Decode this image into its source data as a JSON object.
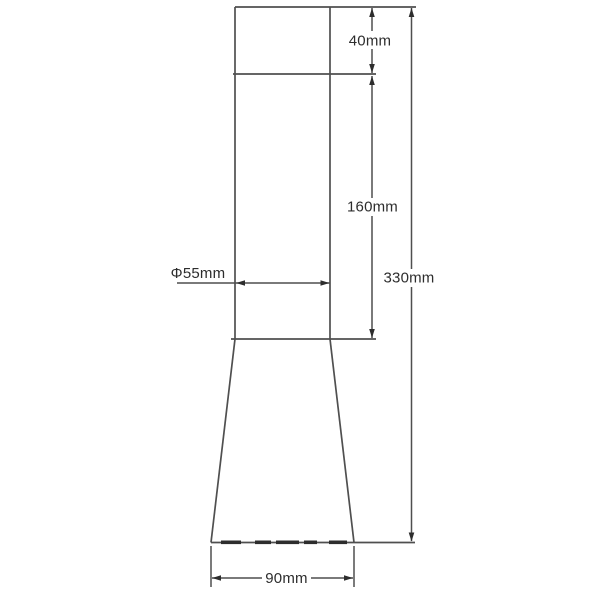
{
  "drawing": {
    "type": "technical-dimension-drawing",
    "labels": {
      "cap_height": "40mm",
      "body_height": "160mm",
      "total_height": "330mm",
      "diameter": "Φ55mm",
      "base_width": "90mm"
    },
    "colors": {
      "line": "#4f4f4f",
      "text": "#2d2d2d",
      "background": "#ffffff"
    }
  }
}
